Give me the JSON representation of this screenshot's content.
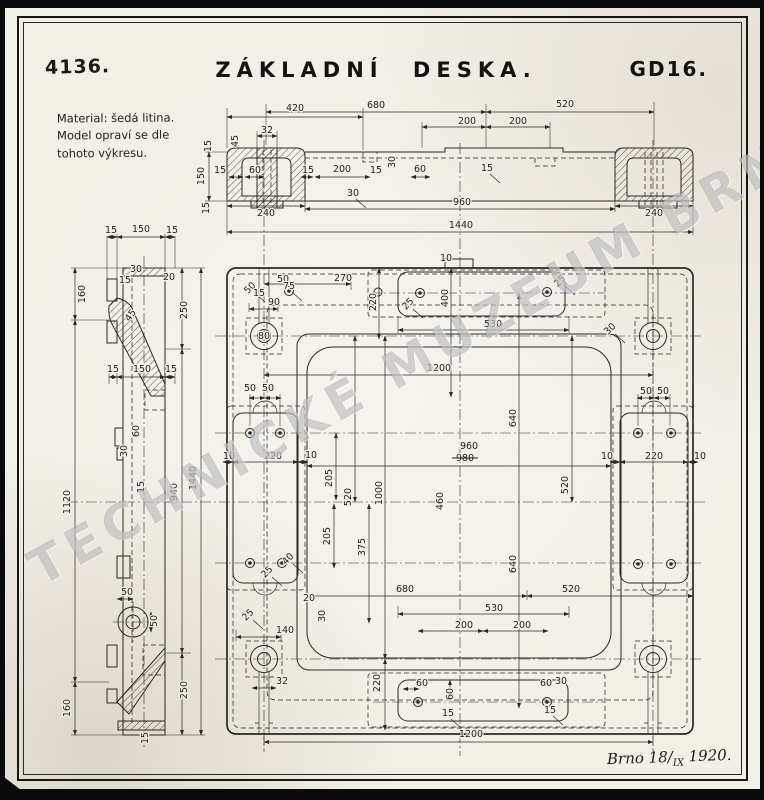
{
  "header": {
    "drawing_number": "4136.",
    "title": "ZÁKLADNÍ DESKA.",
    "code": "GD16."
  },
  "notes": {
    "material_lines": [
      "Material: šedá litina.",
      "Model opraví se dle",
      "tohoto výkresu."
    ]
  },
  "watermark": {
    "text": "TECHNICKÉ MUZEUM BRNĚ"
  },
  "footer": {
    "place_prefix": "Brno 18/",
    "roman": "IX",
    "year_suffix": " 1920."
  },
  "annotations": [
    {
      "t": "420",
      "x": 290,
      "y": 111
    },
    {
      "t": "680",
      "x": 371,
      "y": 108
    },
    {
      "t": "520",
      "x": 560,
      "y": 107
    },
    {
      "t": "200",
      "x": 462,
      "y": 124
    },
    {
      "t": "200",
      "x": 513,
      "y": 124
    },
    {
      "t": "45",
      "x": 233,
      "y": 141,
      "r": -90
    },
    {
      "t": "32",
      "x": 262,
      "y": 133
    },
    {
      "t": "15",
      "x": 215,
      "y": 173
    },
    {
      "t": "60",
      "x": 250,
      "y": 173
    },
    {
      "t": "15",
      "x": 303,
      "y": 173
    },
    {
      "t": "200",
      "x": 337,
      "y": 172
    },
    {
      "t": "15",
      "x": 371,
      "y": 173
    },
    {
      "t": "60",
      "x": 415,
      "y": 172
    },
    {
      "t": "30",
      "x": 390,
      "y": 162,
      "r": -90
    },
    {
      "t": "30",
      "x": 348,
      "y": 196,
      "l": true
    },
    {
      "t": "15",
      "x": 482,
      "y": 171,
      "l": true
    },
    {
      "t": "240",
      "x": 261,
      "y": 216
    },
    {
      "t": "960",
      "x": 457,
      "y": 205
    },
    {
      "t": "240",
      "x": 649,
      "y": 216
    },
    {
      "t": "1440",
      "x": 456,
      "y": 228
    },
    {
      "t": "150",
      "x": 199,
      "y": 176,
      "r": -90
    },
    {
      "t": "15",
      "x": 206,
      "y": 146,
      "r": -90
    },
    {
      "t": "15",
      "x": 204,
      "y": 208,
      "r": -90
    },
    {
      "t": "15",
      "x": 106,
      "y": 233
    },
    {
      "t": "150",
      "x": 136,
      "y": 232
    },
    {
      "t": "15",
      "x": 167,
      "y": 233
    },
    {
      "t": "160",
      "x": 80,
      "y": 294,
      "r": -90
    },
    {
      "t": "30",
      "x": 131,
      "y": 272
    },
    {
      "t": "15",
      "x": 120,
      "y": 283
    },
    {
      "t": "20",
      "x": 164,
      "y": 280
    },
    {
      "t": "250",
      "x": 182,
      "y": 310,
      "r": -90
    },
    {
      "t": "45",
      "x": 128,
      "y": 317,
      "r": -55
    },
    {
      "t": "15",
      "x": 108,
      "y": 372
    },
    {
      "t": "150",
      "x": 137,
      "y": 372
    },
    {
      "t": "15",
      "x": 166,
      "y": 372
    },
    {
      "t": "60",
      "x": 134,
      "y": 431,
      "r": -90
    },
    {
      "t": "30",
      "x": 122,
      "y": 451,
      "r": -90
    },
    {
      "t": "15",
      "x": 139,
      "y": 487,
      "r": -90
    },
    {
      "t": "1120",
      "x": 65,
      "y": 502,
      "r": -90
    },
    {
      "t": "940",
      "x": 172,
      "y": 492,
      "r": -90
    },
    {
      "t": "1440",
      "x": 191,
      "y": 478,
      "r": -90
    },
    {
      "t": "50",
      "x": 122,
      "y": 595
    },
    {
      "t": "50",
      "x": 152,
      "y": 621,
      "r": -90
    },
    {
      "t": "250",
      "x": 182,
      "y": 690,
      "r": -90
    },
    {
      "t": "160",
      "x": 65,
      "y": 708,
      "r": -90
    },
    {
      "t": "15",
      "x": 143,
      "y": 738,
      "r": -90
    },
    {
      "t": "50",
      "x": 247,
      "y": 290,
      "r": -45,
      "l": true
    },
    {
      "t": "50",
      "x": 278,
      "y": 282
    },
    {
      "t": "15",
      "x": 254,
      "y": 296
    },
    {
      "t": "75",
      "x": 284,
      "y": 289,
      "l": true
    },
    {
      "t": "90",
      "x": 269,
      "y": 305
    },
    {
      "t": "270",
      "x": 338,
      "y": 281
    },
    {
      "t": "80",
      "x": 259,
      "y": 339
    },
    {
      "t": "10",
      "x": 441,
      "y": 261
    },
    {
      "t": "220",
      "x": 371,
      "y": 302,
      "r": -90
    },
    {
      "t": "400",
      "x": 443,
      "y": 298,
      "r": -90
    },
    {
      "t": "25",
      "x": 405,
      "y": 306,
      "r": -45,
      "l": true
    },
    {
      "t": "25",
      "x": 557,
      "y": 283,
      "r": -45,
      "l": true
    },
    {
      "t": "530",
      "x": 488,
      "y": 327
    },
    {
      "t": "30",
      "x": 607,
      "y": 331,
      "r": -45,
      "l": true
    },
    {
      "t": "1200",
      "x": 434,
      "y": 371
    },
    {
      "t": "640",
      "x": 511,
      "y": 418,
      "r": -90
    },
    {
      "t": "640",
      "x": 511,
      "y": 564,
      "r": -90
    },
    {
      "t": "50",
      "x": 641,
      "y": 394
    },
    {
      "t": "50",
      "x": 658,
      "y": 394
    },
    {
      "t": "50",
      "x": 245,
      "y": 391
    },
    {
      "t": "50",
      "x": 263,
      "y": 391
    },
    {
      "t": "960",
      "x": 464,
      "y": 449
    },
    {
      "t": "980",
      "x": 460,
      "y": 461,
      "s": true
    },
    {
      "t": "460",
      "x": 438,
      "y": 501,
      "r": -90
    },
    {
      "t": "520",
      "x": 563,
      "y": 485,
      "r": -90
    },
    {
      "t": "520",
      "x": 346,
      "y": 497,
      "r": -90
    },
    {
      "t": "1000",
      "x": 377,
      "y": 493,
      "r": -90
    },
    {
      "t": "205",
      "x": 327,
      "y": 478,
      "r": -90
    },
    {
      "t": "205",
      "x": 325,
      "y": 536,
      "r": -90
    },
    {
      "t": "375",
      "x": 360,
      "y": 547,
      "r": -90
    },
    {
      "t": "10",
      "x": 224,
      "y": 459
    },
    {
      "t": "220",
      "x": 268,
      "y": 459
    },
    {
      "t": "10",
      "x": 306,
      "y": 458
    },
    {
      "t": "10",
      "x": 602,
      "y": 459
    },
    {
      "t": "220",
      "x": 649,
      "y": 459
    },
    {
      "t": "10",
      "x": 695,
      "y": 459
    },
    {
      "t": "40",
      "x": 285,
      "y": 561,
      "r": -45,
      "l": true
    },
    {
      "t": "25",
      "x": 264,
      "y": 574,
      "r": -45,
      "l": true
    },
    {
      "t": "680",
      "x": 400,
      "y": 592
    },
    {
      "t": "520",
      "x": 566,
      "y": 592
    },
    {
      "t": "530",
      "x": 489,
      "y": 611
    },
    {
      "t": "200",
      "x": 459,
      "y": 628
    },
    {
      "t": "200",
      "x": 517,
      "y": 628
    },
    {
      "t": "20",
      "x": 304,
      "y": 601
    },
    {
      "t": "30",
      "x": 320,
      "y": 616,
      "r": -90
    },
    {
      "t": "25",
      "x": 245,
      "y": 617,
      "r": -45,
      "l": true
    },
    {
      "t": "140",
      "x": 280,
      "y": 633
    },
    {
      "t": "32",
      "x": 277,
      "y": 684
    },
    {
      "t": "220",
      "x": 375,
      "y": 683,
      "r": -90
    },
    {
      "t": "60",
      "x": 417,
      "y": 686
    },
    {
      "t": "60",
      "x": 448,
      "y": 694,
      "r": -90
    },
    {
      "t": "15",
      "x": 443,
      "y": 716,
      "l": true
    },
    {
      "t": "60",
      "x": 541,
      "y": 686
    },
    {
      "t": "30",
      "x": 556,
      "y": 684
    },
    {
      "t": "15",
      "x": 545,
      "y": 713,
      "l": true
    },
    {
      "t": "1200",
      "x": 466,
      "y": 737
    }
  ]
}
